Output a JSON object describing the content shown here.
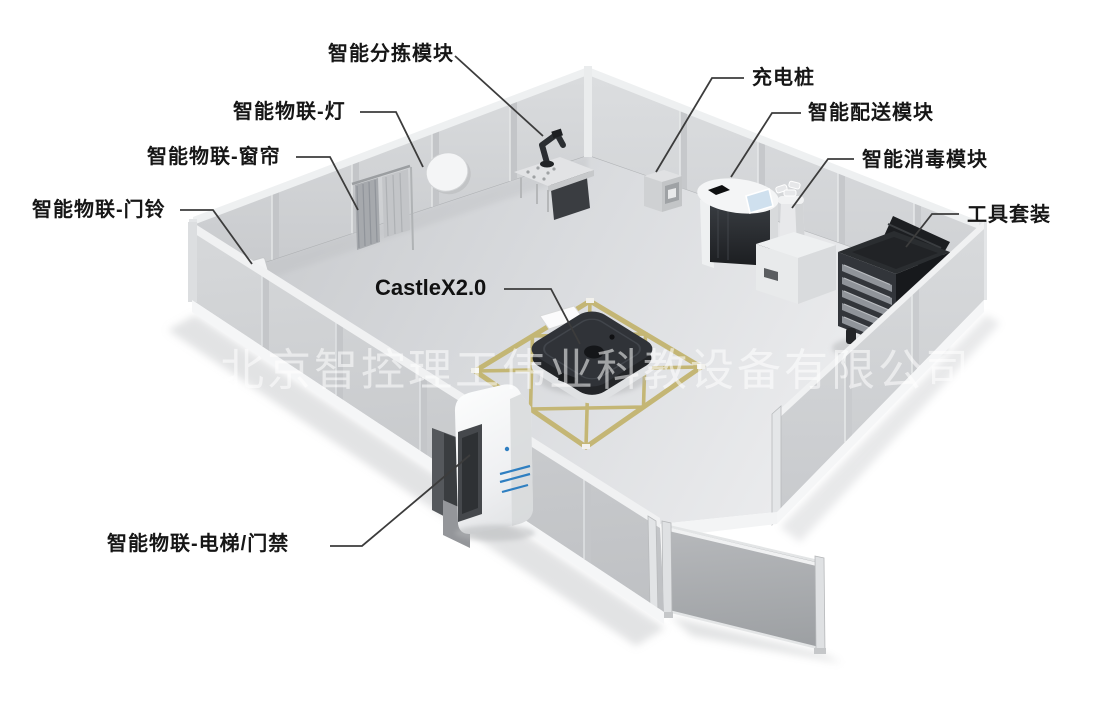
{
  "watermark": "北京智控理工伟业科教设备有限公司",
  "labels": {
    "sorting": "智能分拣模块",
    "light": "智能物联-灯",
    "curtain": "智能物联-窗帘",
    "doorbell": "智能物联-门铃",
    "charging": "充电桩",
    "delivery": "智能配送模块",
    "disinfection": "智能消毒模块",
    "toolkit": "工具套装",
    "robot": "CastleX2.0",
    "elevator": "智能物联-电梯/门禁"
  },
  "scene": {
    "objects": [
      "sorting-robot-arm-station",
      "iot-ceiling-light-disc",
      "iot-curtain",
      "iot-doorbell",
      "charging-pile",
      "delivery-module-cabinet",
      "disinfection-module",
      "tool-cart",
      "castlex-robot-on-floor-marking",
      "elevator-access-gate",
      "aluminum-panel-room",
      "detached-door-panel"
    ],
    "floor_marking": "yellow-tape-diamond-grid"
  },
  "colors": {
    "background": "#ffffff",
    "label_text": "#161616",
    "leader_line": "#3c3c3c",
    "watermark_text": "rgba(255,255,255,0.55)",
    "floor_tape": "#c2b36c",
    "accent_blue": "#2f7fc1",
    "wall_gray": "#d2d4d6",
    "floor_gray": "#dcdee0",
    "device_dark": "#2b2d31"
  }
}
